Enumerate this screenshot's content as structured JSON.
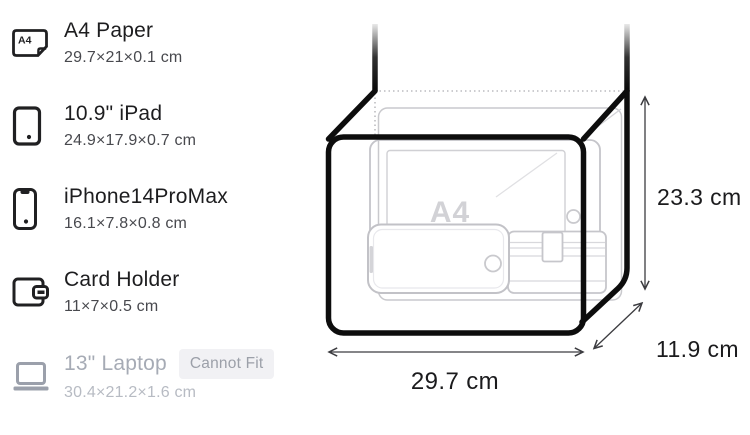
{
  "items": [
    {
      "name": "A4 Paper",
      "dims": "29.7×21×0.1 cm",
      "icon": "a4-paper-icon",
      "icon_label": "A4",
      "fits": true
    },
    {
      "name": "10.9\" iPad",
      "dims": "24.9×17.9×0.7 cm",
      "icon": "ipad-icon",
      "fits": true
    },
    {
      "name": "iPhone14ProMax",
      "dims": "16.1×7.8×0.8 cm",
      "icon": "iphone-icon",
      "fits": true
    },
    {
      "name": "Card Holder",
      "dims": "11×7×0.5 cm",
      "icon": "card-holder-icon",
      "fits": true
    },
    {
      "name": "13\" Laptop",
      "dims": "30.4×21.2×1.6 cm",
      "icon": "laptop-icon",
      "fits": false,
      "badge": "Cannot Fit"
    }
  ],
  "diagram": {
    "width_label": "29.7 cm",
    "height_label": "23.3 cm",
    "depth_label": "11.9 cm",
    "contents_label": "A4"
  },
  "colors": {
    "title": "#1d1d1f",
    "dims": "#48494e",
    "disabled_title": "#a6abb5",
    "disabled_dims": "#b7bbc3",
    "badge_bg": "#f1f1f4",
    "badge_text": "#9ca0a9",
    "bag_outline": "#0d0d0d",
    "sketch_gray": "#c7c7cc",
    "dimension_line": "#3c3c40"
  }
}
